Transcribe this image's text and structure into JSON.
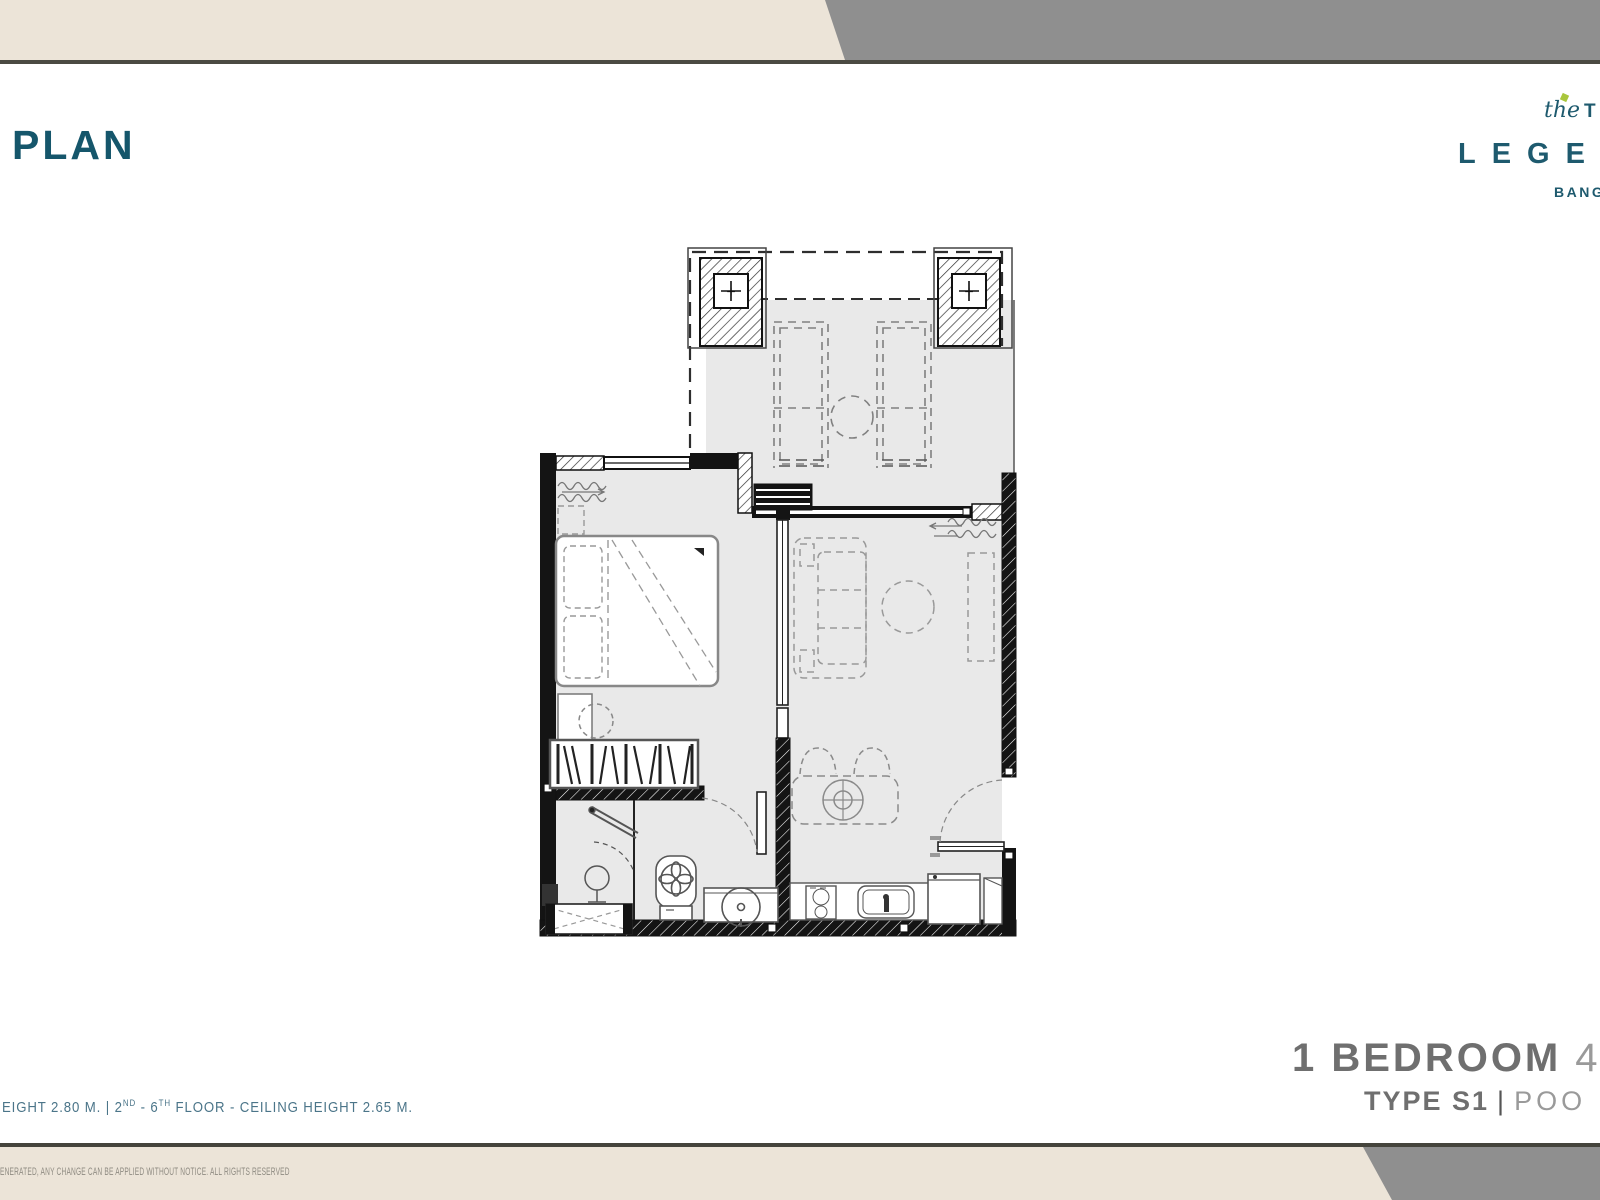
{
  "header": {
    "title": "PLAN",
    "beige": "#ece4d8",
    "gray": "#8f8f8f",
    "rule": "#45443c",
    "title_color": "#15566b"
  },
  "logo": {
    "script": "the",
    "caps": "TI",
    "line2": "LEGEN",
    "line3": "BANG",
    "teal": "#1e5a6e",
    "lime": "#a9c63c"
  },
  "floorplan": {
    "column_plus": "+",
    "rooms": [
      "terrace-pool-access",
      "bedroom",
      "living-dining",
      "bathroom",
      "kitchen"
    ],
    "fixtures": [
      "pool-edge",
      "daybeds",
      "structural-columns",
      "bed",
      "wardrobe-rack",
      "dresser-stool",
      "sofa",
      "coffee-table",
      "tv-cabinet",
      "dining-table",
      "dining-chairs",
      "entrance-door",
      "stove",
      "kitchen-sink",
      "refrigerator",
      "toilet",
      "shower",
      "basin",
      "ac-ledge"
    ],
    "floor_fill": "#e9e9e9",
    "wall_color": "#141414"
  },
  "unit_info": {
    "line1_bold": "1 BEDROOM",
    "line1_light": "4",
    "line2_bold": "TYPE S1",
    "separator": "|",
    "line2_light": "POO",
    "bold_color": "#6f6f6f",
    "light_color": "#9a9a9a"
  },
  "floor_note": {
    "p1": "EIGHT 2.80 M. | 2",
    "s1": "ND",
    "p2": " - 6",
    "s2": "TH",
    "p3": " FLOOR - CEILING HEIGHT 2.65 M.",
    "color": "#4b7589"
  },
  "legal": {
    "text": "ENERATED, ANY CHANGE CAN BE APPLIED WITHOUT NOTICE. ALL RIGHTS RESERVED",
    "color": "#8f8b82"
  }
}
